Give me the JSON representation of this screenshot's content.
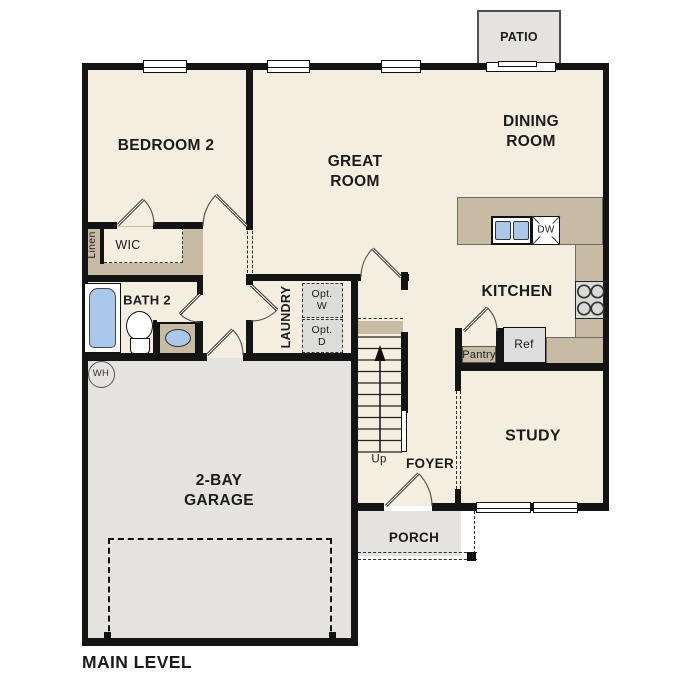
{
  "title": "MAIN LEVEL",
  "rooms": {
    "bedroom2": "BEDROOM 2",
    "great_room": "GREAT\nROOM",
    "dining_room": "DINING\nROOM",
    "kitchen": "KITCHEN",
    "study": "STUDY",
    "foyer": "FOYER",
    "garage": "2-BAY\nGARAGE",
    "bath2": "BATH 2",
    "laundry": "LAUNDRY",
    "wic": "WIC",
    "linen": "Linen",
    "porch": "PORCH",
    "patio": "PATIO"
  },
  "annotations": {
    "washer_opt": "Opt.\nW",
    "dryer_opt": "Opt.\nD",
    "pantry": "Pantry",
    "refrigerator": "Ref",
    "dishwasher": "DW",
    "water_heater": "WH",
    "stairs_direction": "Up"
  },
  "colors": {
    "floor": "#f4eee1",
    "hardscape": "#e4e3e0",
    "counter_tan": "#c8bba3",
    "fixture_blue": "#a9c8ea",
    "wall": "#141414",
    "appliance_gray": "#dcdcda"
  }
}
